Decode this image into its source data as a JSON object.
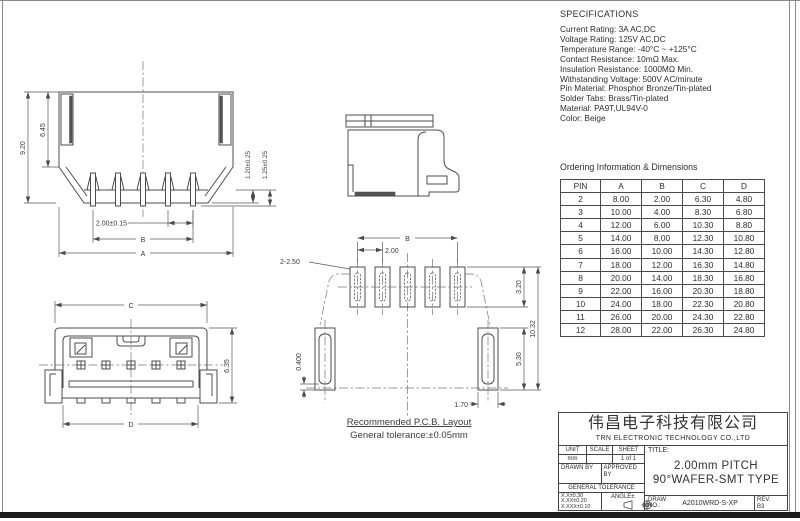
{
  "specifications": {
    "title": "SPECIFICATIONS",
    "lines": [
      "Current Rating: 3A AC,DC",
      "Voltage Rating: 125V AC,DC",
      "Temperature Range: -40°C ~ +125°C",
      "Contact Resistance: 10mΩ Max.",
      "Insulation Resistance: 1000MΩ Min.",
      "Withstanding Voltage: 500V AC/minute",
      "Pin Material: Phosphor Bronze/Tin-plated",
      "Solder Tabs: Brass/Tin-plated",
      "Material: PA9T,UL94V-0",
      "Color: Beige"
    ]
  },
  "ordering": {
    "title": "Ordering Information & Dimensions",
    "headers": [
      "PIN",
      "A",
      "B",
      "C",
      "D"
    ],
    "rows": [
      [
        "2",
        "8.00",
        "2.00",
        "6.30",
        "4.80"
      ],
      [
        "3",
        "10.00",
        "4.00",
        "8.30",
        "6.80"
      ],
      [
        "4",
        "12.00",
        "6.00",
        "10.30",
        "8.80"
      ],
      [
        "5",
        "14.00",
        "8.00",
        "12.30",
        "10.80"
      ],
      [
        "6",
        "16.00",
        "10.00",
        "14.30",
        "12.80"
      ],
      [
        "7",
        "18.00",
        "12.00",
        "16.30",
        "14.80"
      ],
      [
        "8",
        "20.00",
        "14.00",
        "18.30",
        "16.80"
      ],
      [
        "9",
        "22.00",
        "16.00",
        "20.30",
        "18.80"
      ],
      [
        "10",
        "24.00",
        "18.00",
        "22.30",
        "20.80"
      ],
      [
        "11",
        "26.00",
        "20.00",
        "24.30",
        "22.80"
      ],
      [
        "12",
        "28.00",
        "22.00",
        "26.30",
        "24.80"
      ]
    ]
  },
  "front_view": {
    "dims": {
      "h_total": "9.20",
      "h_body": "6.45",
      "pin_h1": "1.20±0.25",
      "pin_h2": "1.25±0.25",
      "pitch": "2.00±0.15",
      "b": "B",
      "a": "A"
    }
  },
  "top_view": {
    "dims": {
      "c": "C",
      "d": "D",
      "h": "6.35"
    }
  },
  "pcb": {
    "title": "Recommended P.C.B. Layout",
    "subtitle": "General tolerance:±0.05mm",
    "dims": {
      "b": "B",
      "pitch": "2.00",
      "holes": "2-2.50",
      "h1": "3.20",
      "h2": "10.32",
      "h3": "5.30",
      "w1": "1.70",
      "w2": "0.400"
    }
  },
  "title_block": {
    "company_cn": "伟昌电子科技有限公司",
    "company_en": "TRN ELECTRONIC TECHNOLOGY CO.,LTD",
    "unit_label": "UNIT",
    "unit_value": "mm",
    "scale_label": "SCALE",
    "scale_value": "",
    "sheet_label": "SHEET",
    "sheet_value": "1 of 1",
    "drawn_label": "DRAWN BY",
    "approved_label": "APPROVED BY",
    "general_tolerance_label": "GENERAL TOLERANCE",
    "tolerances": [
      "X.X±0.30",
      "X.XX±0.20",
      "X.XXX±0.10"
    ],
    "angle_label": "ANGLE±",
    "title_label": "TITLE:",
    "title_line1": "2.00mm PITCH",
    "title_line2": "90°WAFER-SMT TYPE",
    "draw_label": "DRAW",
    "no_label": "NO.:",
    "draw_no": "A2010WRD-S-XP",
    "rev_label": "REV.",
    "rev_value": "B3"
  }
}
